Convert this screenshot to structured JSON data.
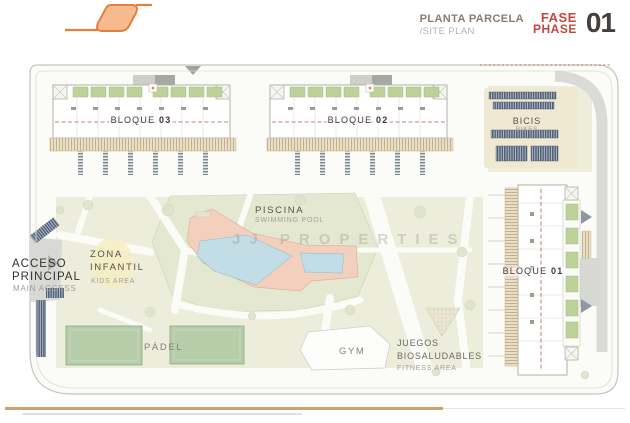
{
  "header": {
    "title_es": "PLANTA PARCELA",
    "title_en": "/SITE PLAN",
    "fase": "FASE",
    "phase": "PHASE",
    "number": "01"
  },
  "plan": {
    "blocks": [
      {
        "label": "BLOQUE",
        "number": "03"
      },
      {
        "label": "BLOQUE",
        "number": "02"
      },
      {
        "label": "BLOQUE",
        "number": "01"
      }
    ],
    "areas": {
      "pool": {
        "title": "PISCINA",
        "subtitle": "SWIMMING POOL"
      },
      "kids": {
        "line1": "ZONA",
        "line2": "INFANTIL",
        "subtitle": "KIDS AREA"
      },
      "access": {
        "line1": "ACCESO",
        "line2": "PRINCIPAL",
        "subtitle": "MAIN ACCESS"
      },
      "padel": {
        "title": "PÁDEL"
      },
      "gym": {
        "title": "GYM"
      },
      "fitness": {
        "line1": "JUEGOS",
        "line2": "BIOSALUDABLES",
        "subtitle": "FITNESS AREA"
      },
      "bikes": {
        "title": "BICIS",
        "subtitle": "BIKES"
      }
    },
    "watermark": "JJ PROPERTIES"
  },
  "colors": {
    "logo_stroke": "#e2813f",
    "logo_fill": "#f7b98e",
    "phase_red": "#c3473c",
    "lawn_green": "#eceedb",
    "roof_green": "#bdd199",
    "court_green": "#b7cdaa",
    "pool_blue": "#c3dde6",
    "deck_salmon": "#f3d0bd",
    "rack_navy": "#4f6078",
    "footer_rule": "#d49f6f"
  }
}
